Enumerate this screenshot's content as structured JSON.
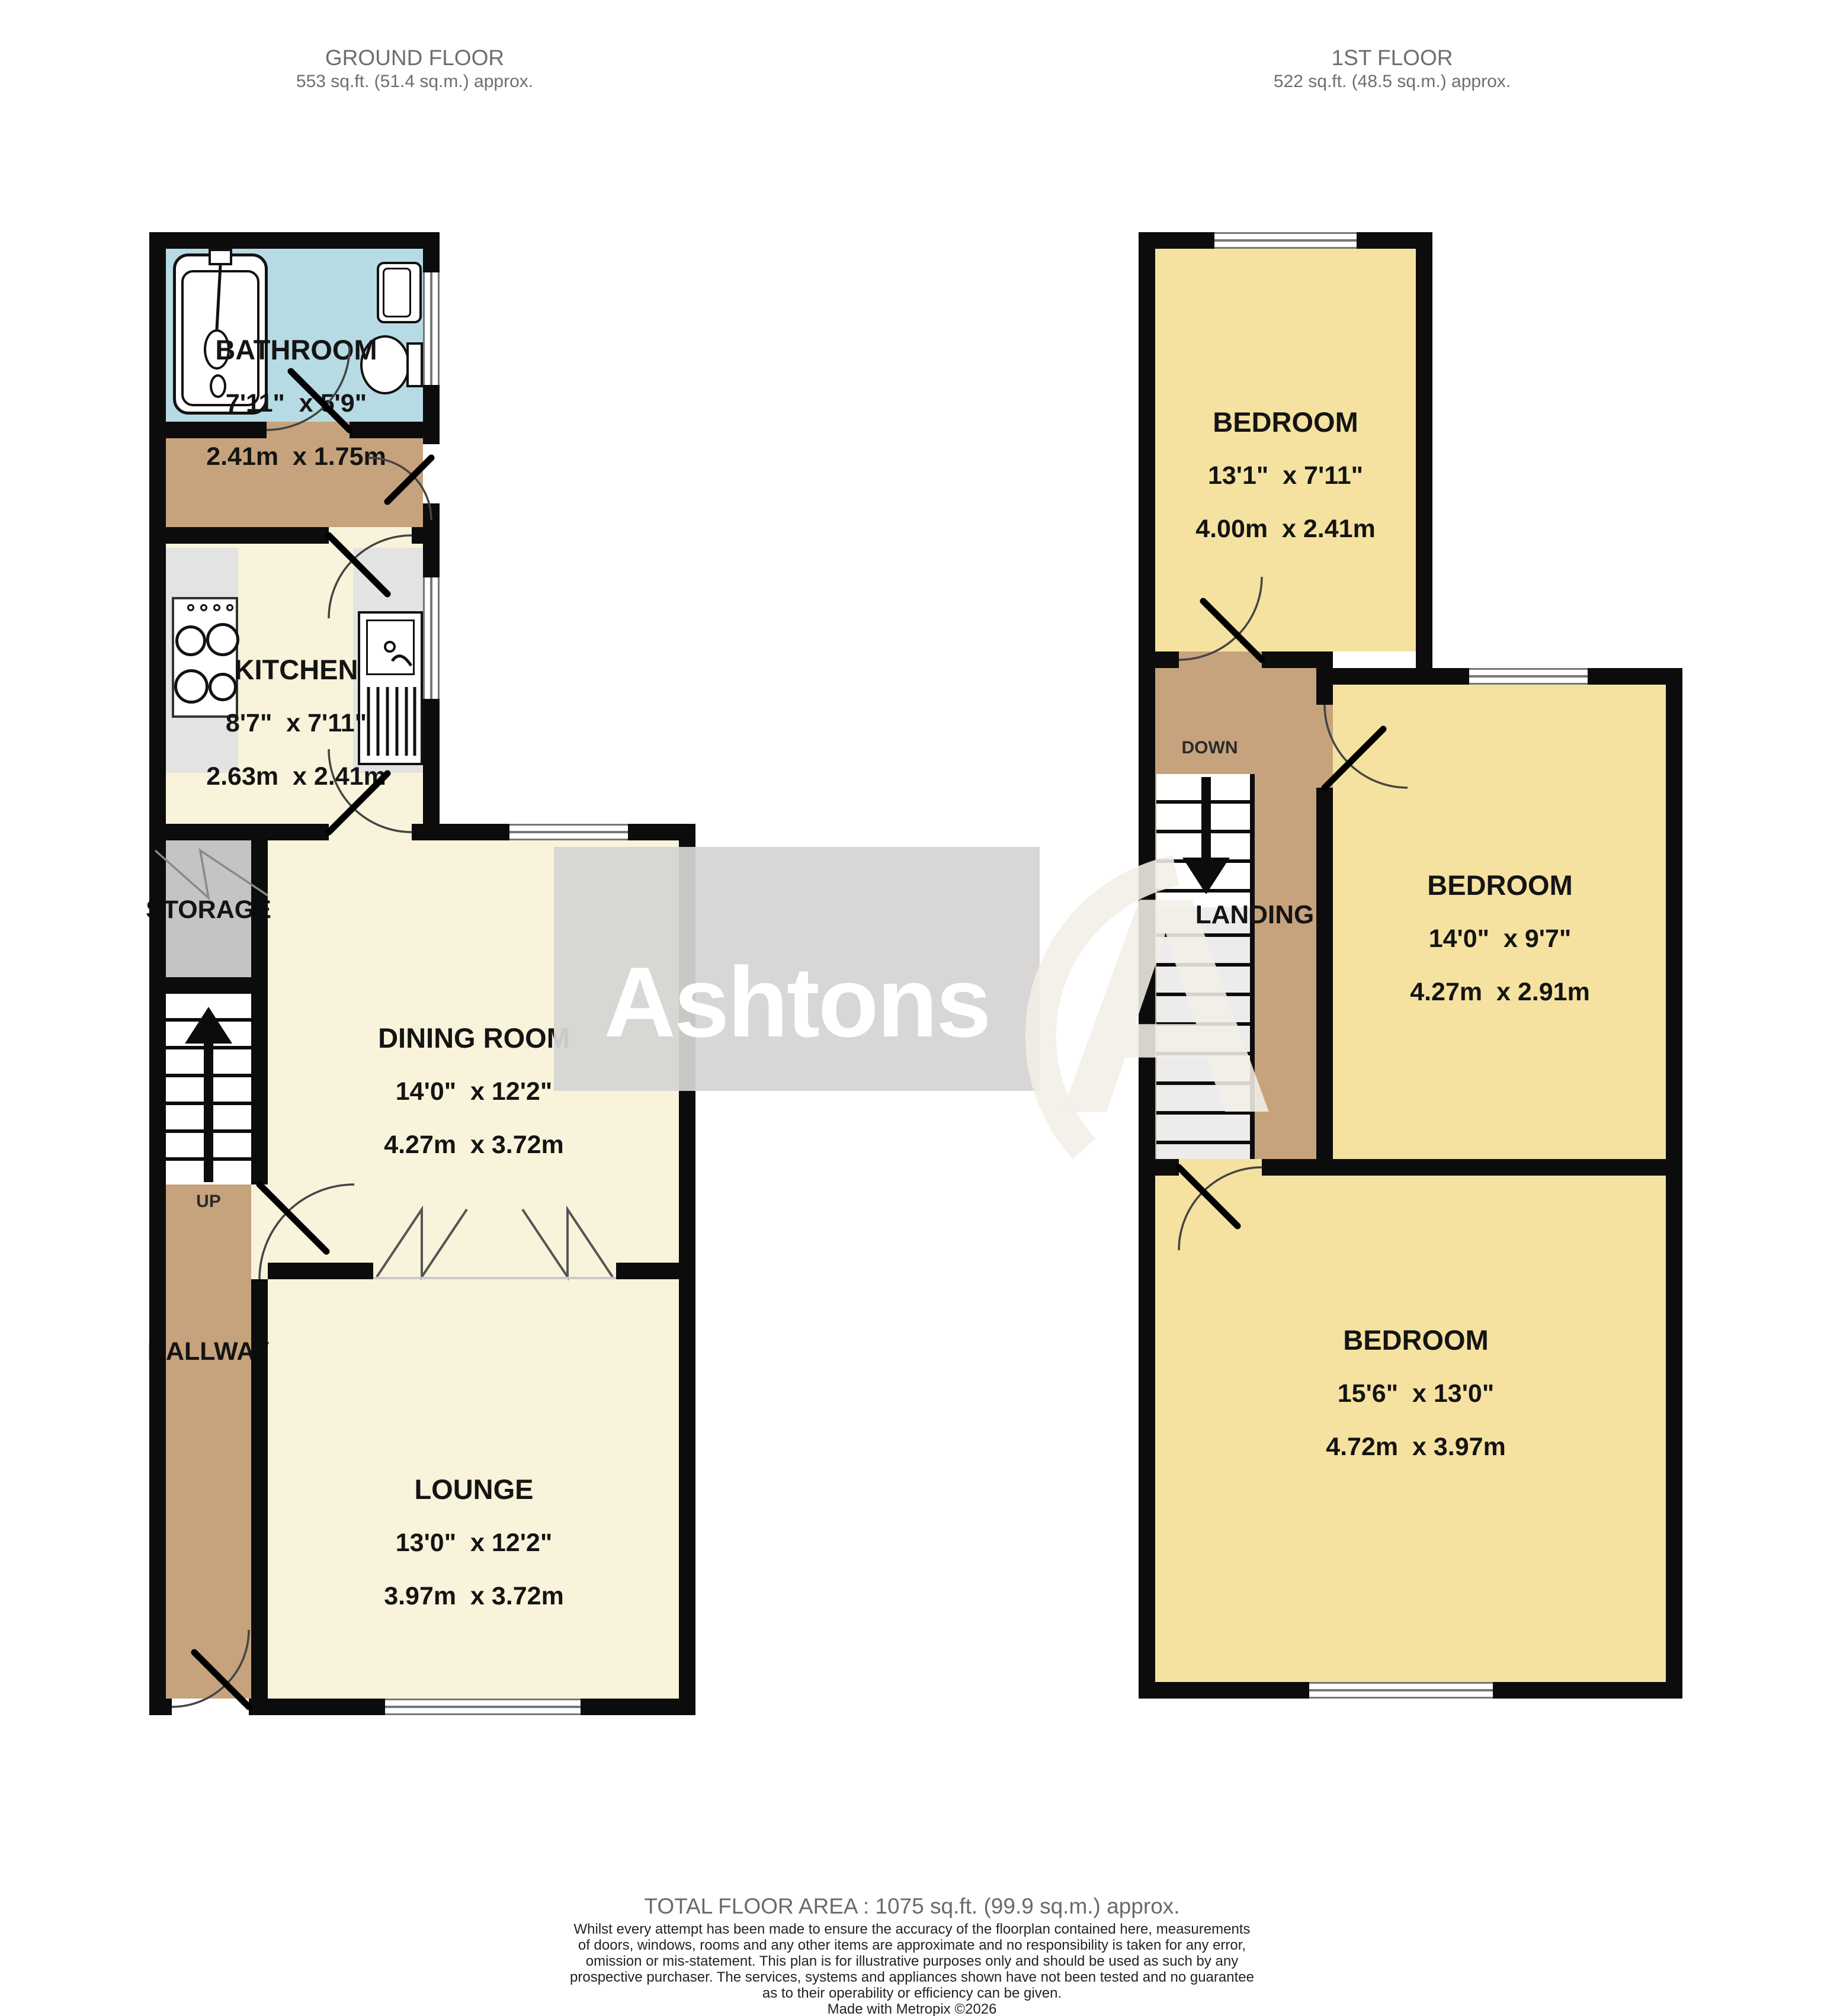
{
  "ground_floor": {
    "title": "GROUND FLOOR",
    "area": "553 sq.ft. (51.4 sq.m.) approx.",
    "rooms": {
      "bathroom": {
        "name": "BATHROOM",
        "imperial": "7'11\"  x 5'9\"",
        "metric": "2.41m  x 1.75m"
      },
      "kitchen": {
        "name": "KITCHEN",
        "imperial": "8'7\"  x 7'11\"",
        "metric": "2.63m  x 2.41m"
      },
      "dining": {
        "name": "DINING ROOM",
        "imperial": "14'0\"  x 12'2\"",
        "metric": "4.27m  x 3.72m"
      },
      "lounge": {
        "name": "LOUNGE",
        "imperial": "13'0\"  x 12'2\"",
        "metric": "3.97m  x 3.72m"
      },
      "storage": {
        "name": "STORAGE"
      },
      "hallway": {
        "name": "HALLWAY"
      }
    },
    "stairs_label": "UP"
  },
  "first_floor": {
    "title": "1ST FLOOR",
    "area": "522 sq.ft. (48.5 sq.m.) approx.",
    "rooms": {
      "bedroom1": {
        "name": "BEDROOM",
        "imperial": "13'1\"  x 7'11\"",
        "metric": "4.00m  x 2.41m"
      },
      "bedroom2": {
        "name": "BEDROOM",
        "imperial": "14'0\"  x 9'7\"",
        "metric": "4.27m  x 2.91m"
      },
      "bedroom3": {
        "name": "BEDROOM",
        "imperial": "15'6\"  x 13'0\"",
        "metric": "4.72m  x 3.97m"
      },
      "landing": {
        "name": "LANDING"
      }
    },
    "stairs_label": "DOWN"
  },
  "watermark": {
    "brand": "Ashtons"
  },
  "footer": {
    "total_area": "TOTAL FLOOR AREA : 1075 sq.ft. (99.9 sq.m.) approx.",
    "disclaimer_lines": [
      "Whilst every attempt has been made to ensure the accuracy of the floorplan contained here, measurements",
      "of doors, windows, rooms and any other items are approximate and no responsibility is taken for any error,",
      "omission or mis-statement. This plan is for illustrative purposes only and should be used as such by any",
      "prospective purchaser. The services, systems and appliances shown have not been tested and no guarantee",
      "as to their operability or efficiency can be given."
    ],
    "credit": "Made with Metropix ©2026"
  },
  "colors": {
    "wall": "#0c0c0c",
    "ground_room_floor": "#f8f3da",
    "bedroom_floor": "#f5e2a0",
    "hall_floor": "#c6a37d",
    "bathroom_floor": "#b7dbe4",
    "storage_floor": "#c4c4c4",
    "counter": "#e3e3e3",
    "watermark_box": "#d6d5d2"
  }
}
